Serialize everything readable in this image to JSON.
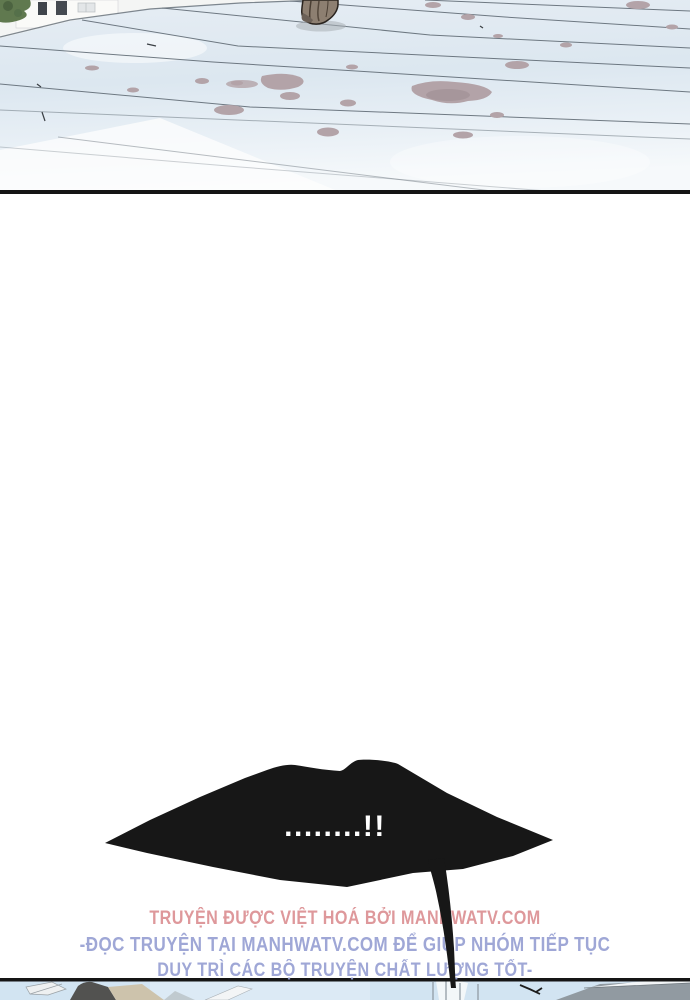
{
  "page": {
    "width": 690,
    "height": 1000,
    "background": "#ffffff"
  },
  "top_panel": {
    "type": "artwork",
    "description": "Snow-covered sloped roof with thin contour lines, scattered mauve stains, a figure's foot at top center, white building and green foliage in the top-left corner",
    "colors": {
      "ice": "#dfe9f1",
      "stains": "#b3a3a8",
      "contour_line": "#515c66",
      "foliage": "#60794f",
      "building": "#fafaf8",
      "foot": "#8d7f71"
    }
  },
  "divider": {
    "color": "#151515"
  },
  "speech_bubble": {
    "text": "........!!",
    "fill": "#171717",
    "text_color": "#ffffff"
  },
  "credits": {
    "line1": {
      "text": "TRUYỆN ĐƯỢC VIỆT HOÁ BỞI MANHWATV.COM",
      "color": "#dc9093"
    },
    "line2": {
      "text": "-ĐỌC TRUYỆN TẠI MANHWATV.COM ĐỂ GIÚP NHÓM TIẾP TỤC",
      "color": "#97a0d3"
    },
    "line3": {
      "text": "DUY TRÌ CÁC BỘ TRUYỆN CHẤT LƯỢNG TỐT-",
      "color": "#97a0d3"
    }
  },
  "bottom_panel": {
    "type": "artwork",
    "description": "Top sliver of the next panel: rooftops, beams and sky",
    "colors": {
      "sky": "#d2e4f2",
      "roof_dark": "#525250",
      "roof_beige": "#cdc3ac",
      "roof_gray": "#919aa1",
      "border": "#151515"
    }
  }
}
